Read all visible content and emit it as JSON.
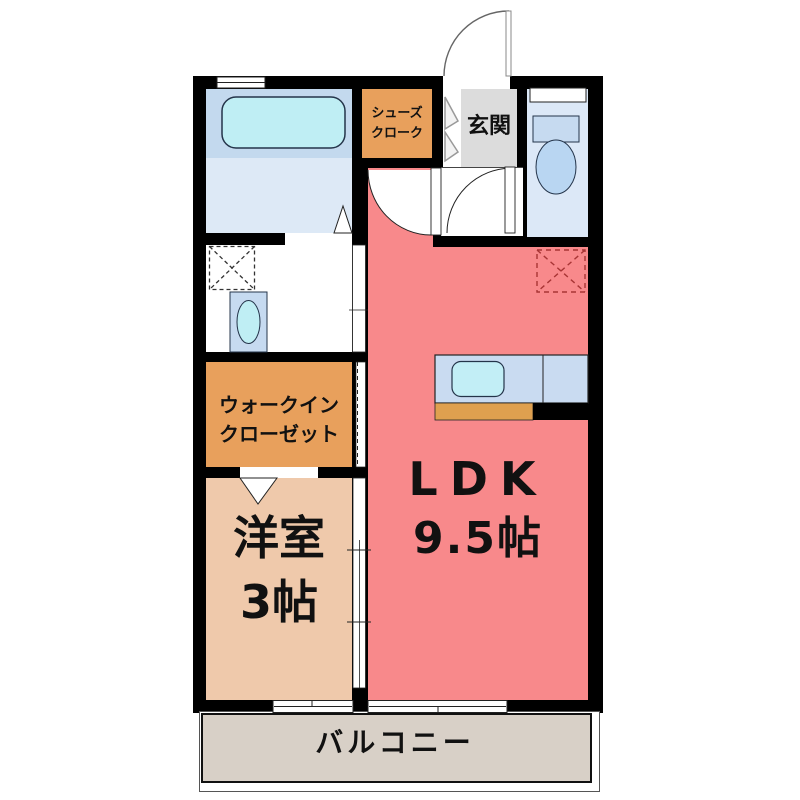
{
  "title": "1LDK apartment floor plan",
  "rooms": {
    "bathroom": {
      "fixture": "bathtub-icon"
    },
    "washroom": {
      "fixtures": [
        "washing-machine-space-icon",
        "vanity-sink-icon"
      ]
    },
    "shoe_closet": {
      "label_line1": "シューズ",
      "label_line2": "クローク"
    },
    "entrance": {
      "label": "玄関"
    },
    "toilet": {
      "fixture": "toilet-icon"
    },
    "walk_in_closet": {
      "label_line1": "ウォークイン",
      "label_line2": "クローゼット"
    },
    "western_room": {
      "label_line1": "洋室",
      "label_line2": "3帖"
    },
    "ldk": {
      "label_line1": "LDK",
      "label_line2": "9.5帖"
    },
    "kitchen": {
      "fixtures": [
        "kitchen-counter",
        "kitchen-sink-icon",
        "refrigerator-space-icon"
      ]
    },
    "balcony": {
      "label": "バルコニー"
    }
  },
  "colors": {
    "wall": "#000000",
    "ldk_salmon": "#f8898b",
    "closet_orange": "#e8a05c",
    "western_peach": "#efc9ab",
    "entrance_gray": "#dcdcdc",
    "toilet_blue": "#dce8f7",
    "bath_upper": "#c3d9ee",
    "bath_lower": "#dde9f6",
    "fixture_cyan": "#bfeef4",
    "fixture_blue": "#c6daf0",
    "kitchen_counter": "#c9dbf1",
    "kitchen_cabinet": "#dfa04f",
    "balcony_beige": "#d8d0c7",
    "fridge_dash": "#a83535"
  }
}
